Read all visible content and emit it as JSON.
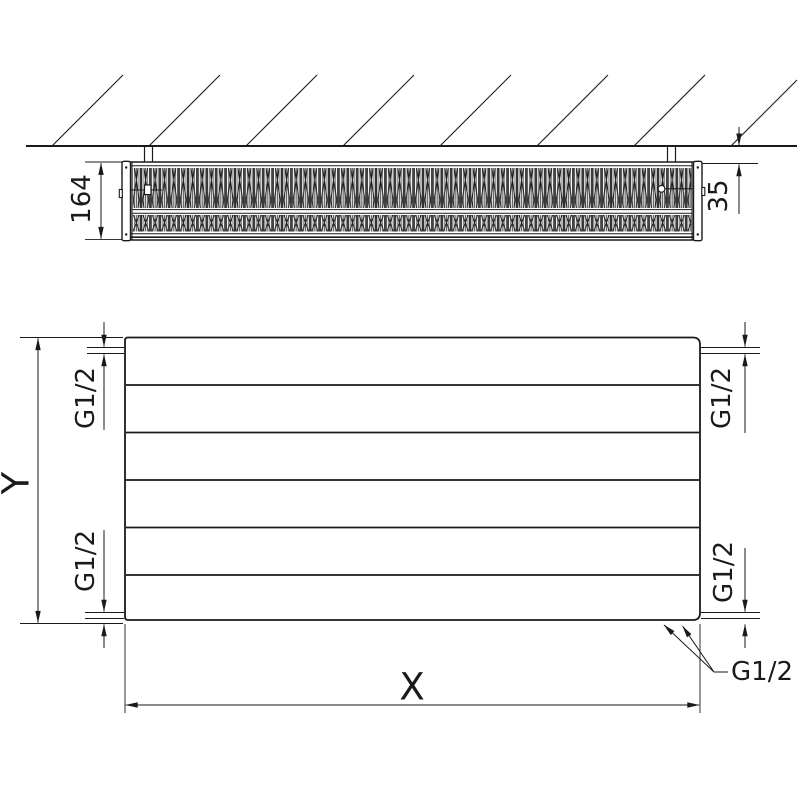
{
  "drawing": {
    "labels": {
      "depth": "164",
      "wall_gap": "35",
      "height": "Y",
      "width": "X",
      "thread": "G1/2"
    },
    "colors": {
      "line": "#1a1a1a",
      "background": "#ffffff"
    }
  }
}
